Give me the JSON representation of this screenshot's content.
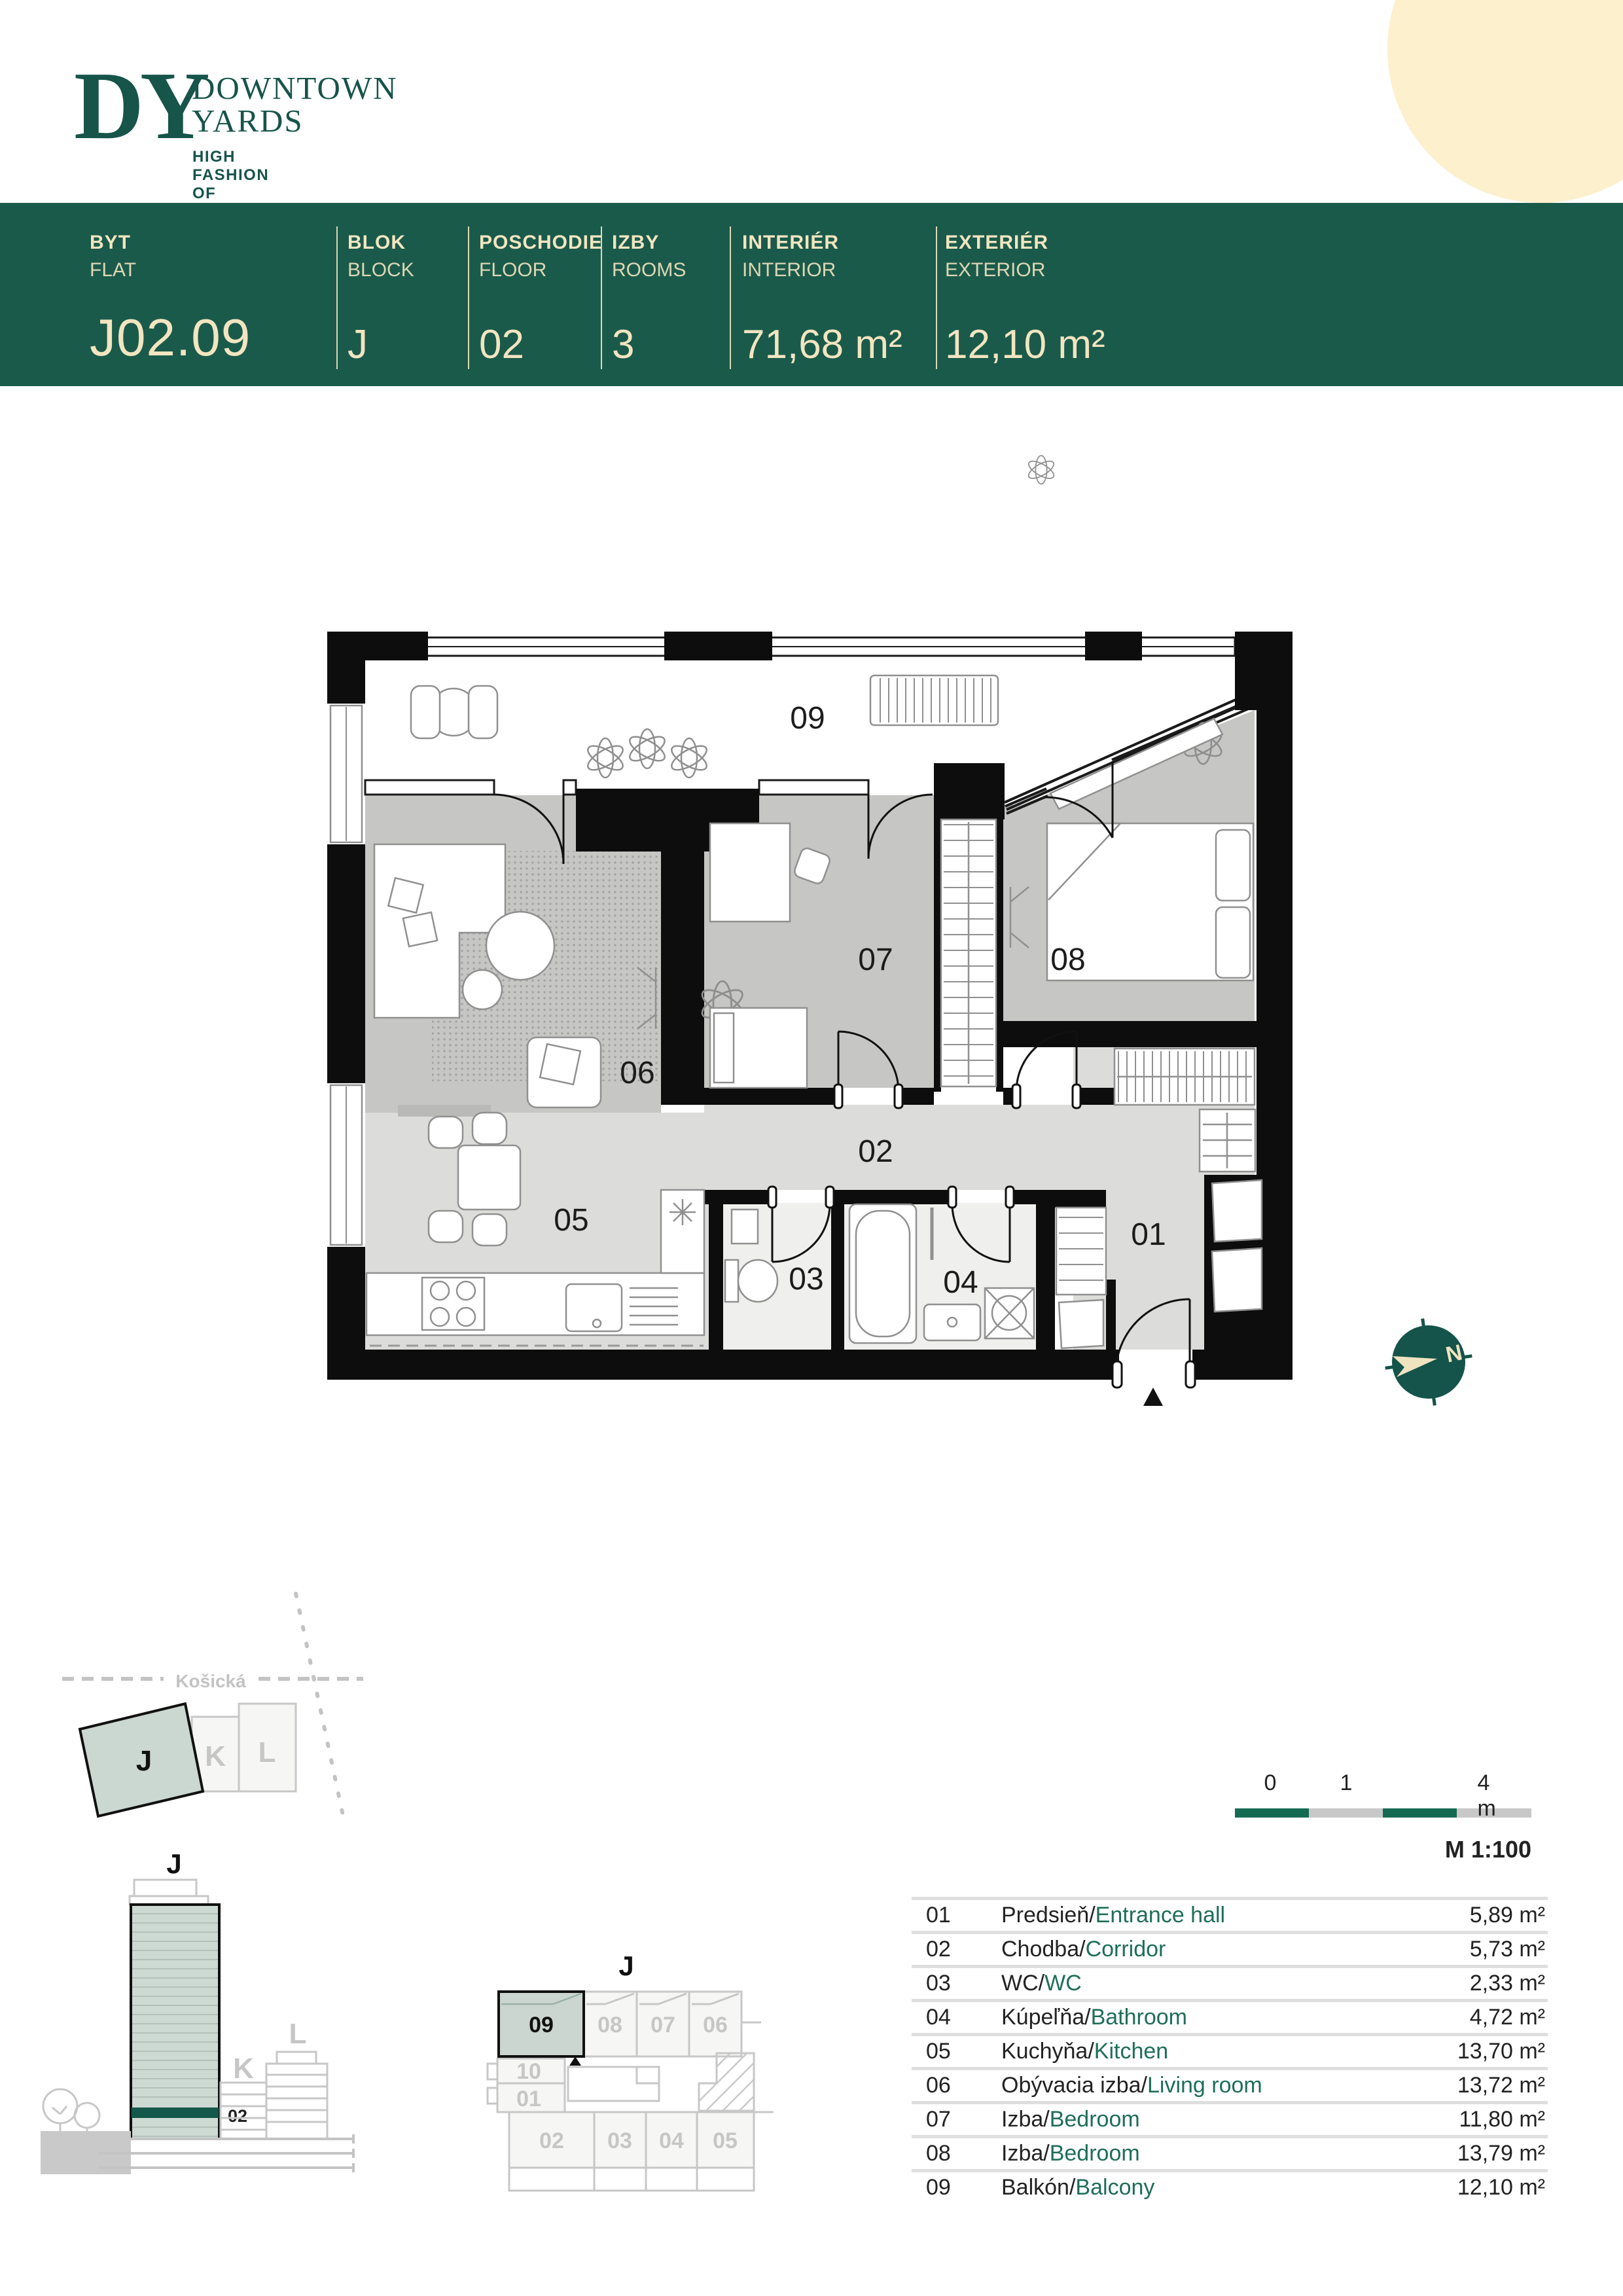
{
  "logo": {
    "monogram": "DY",
    "line1": "DOWNTOWN",
    "line2": "YARDS",
    "tagline": "HIGH FASHION OF LIVING"
  },
  "header": {
    "cells": [
      {
        "sk": "BYT",
        "en": "FLAT",
        "value": "J02.09"
      },
      {
        "sk": "BLOK",
        "en": "BLOCK",
        "value": "J"
      },
      {
        "sk": "POSCHODIE",
        "en": "FLOOR",
        "value": "02"
      },
      {
        "sk": "IZBY",
        "en": "ROOMS",
        "value": "3"
      },
      {
        "sk": "INTERIÉR",
        "en": "INTERIOR",
        "value": "71,68 m²"
      },
      {
        "sk": "EXTERIÉR",
        "en": "EXTERIOR",
        "value": "12,10 m²"
      }
    ]
  },
  "plan": {
    "room_labels": {
      "r01": "01",
      "r02": "02",
      "r03": "03",
      "r04": "04",
      "r05": "05",
      "r06": "06",
      "r07": "07",
      "r08": "08",
      "r09": "09"
    }
  },
  "compass": {
    "north_label": "N"
  },
  "site_plan": {
    "street": "Košická",
    "blocks": {
      "j": "J",
      "k": "K",
      "l": "L"
    }
  },
  "elevation": {
    "building": "J",
    "floor": "02",
    "neighbor_k": "K",
    "neighbor_l": "L"
  },
  "floor_key": {
    "building": "J",
    "units": {
      "u01": "01",
      "u02": "02",
      "u03": "03",
      "u04": "04",
      "u05": "05",
      "u06": "06",
      "u07": "07",
      "u08": "08",
      "u09": "09",
      "u10": "10"
    }
  },
  "scale_bar": {
    "tick0": "0",
    "tick1": "1",
    "tick4": "4 m",
    "scale": "M 1:100"
  },
  "legend": {
    "rows": [
      {
        "no": "01",
        "sk": "Predsieň",
        "en": "Entrance hall",
        "area": "5,89 m²"
      },
      {
        "no": "02",
        "sk": "Chodba",
        "en": "Corridor",
        "area": "5,73 m²"
      },
      {
        "no": "03",
        "sk": "WC",
        "en": "WC",
        "area": "2,33 m²"
      },
      {
        "no": "04",
        "sk": "Kúpeľňa",
        "en": "Bathroom",
        "area": "4,72 m²"
      },
      {
        "no": "05",
        "sk": "Kuchyňa",
        "en": "Kitchen",
        "area": "13,70 m²"
      },
      {
        "no": "06",
        "sk": "Obývacia izba",
        "en": "Living room",
        "area": "13,72 m²"
      },
      {
        "no": "07",
        "sk": "Izba",
        "en": "Bedroom",
        "area": "11,80 m²"
      },
      {
        "no": "08",
        "sk": "Izba",
        "en": "Bedroom",
        "area": "13,79 m²"
      },
      {
        "no": "09",
        "sk": "Balkón",
        "en": "Balcony",
        "area": "12,10 m²"
      }
    ]
  },
  "colors": {
    "brand_green": "#1a5a4b",
    "cream": "#f2e5c0",
    "sage": "#ccd6d0",
    "legend_green": "#1e6e58"
  }
}
